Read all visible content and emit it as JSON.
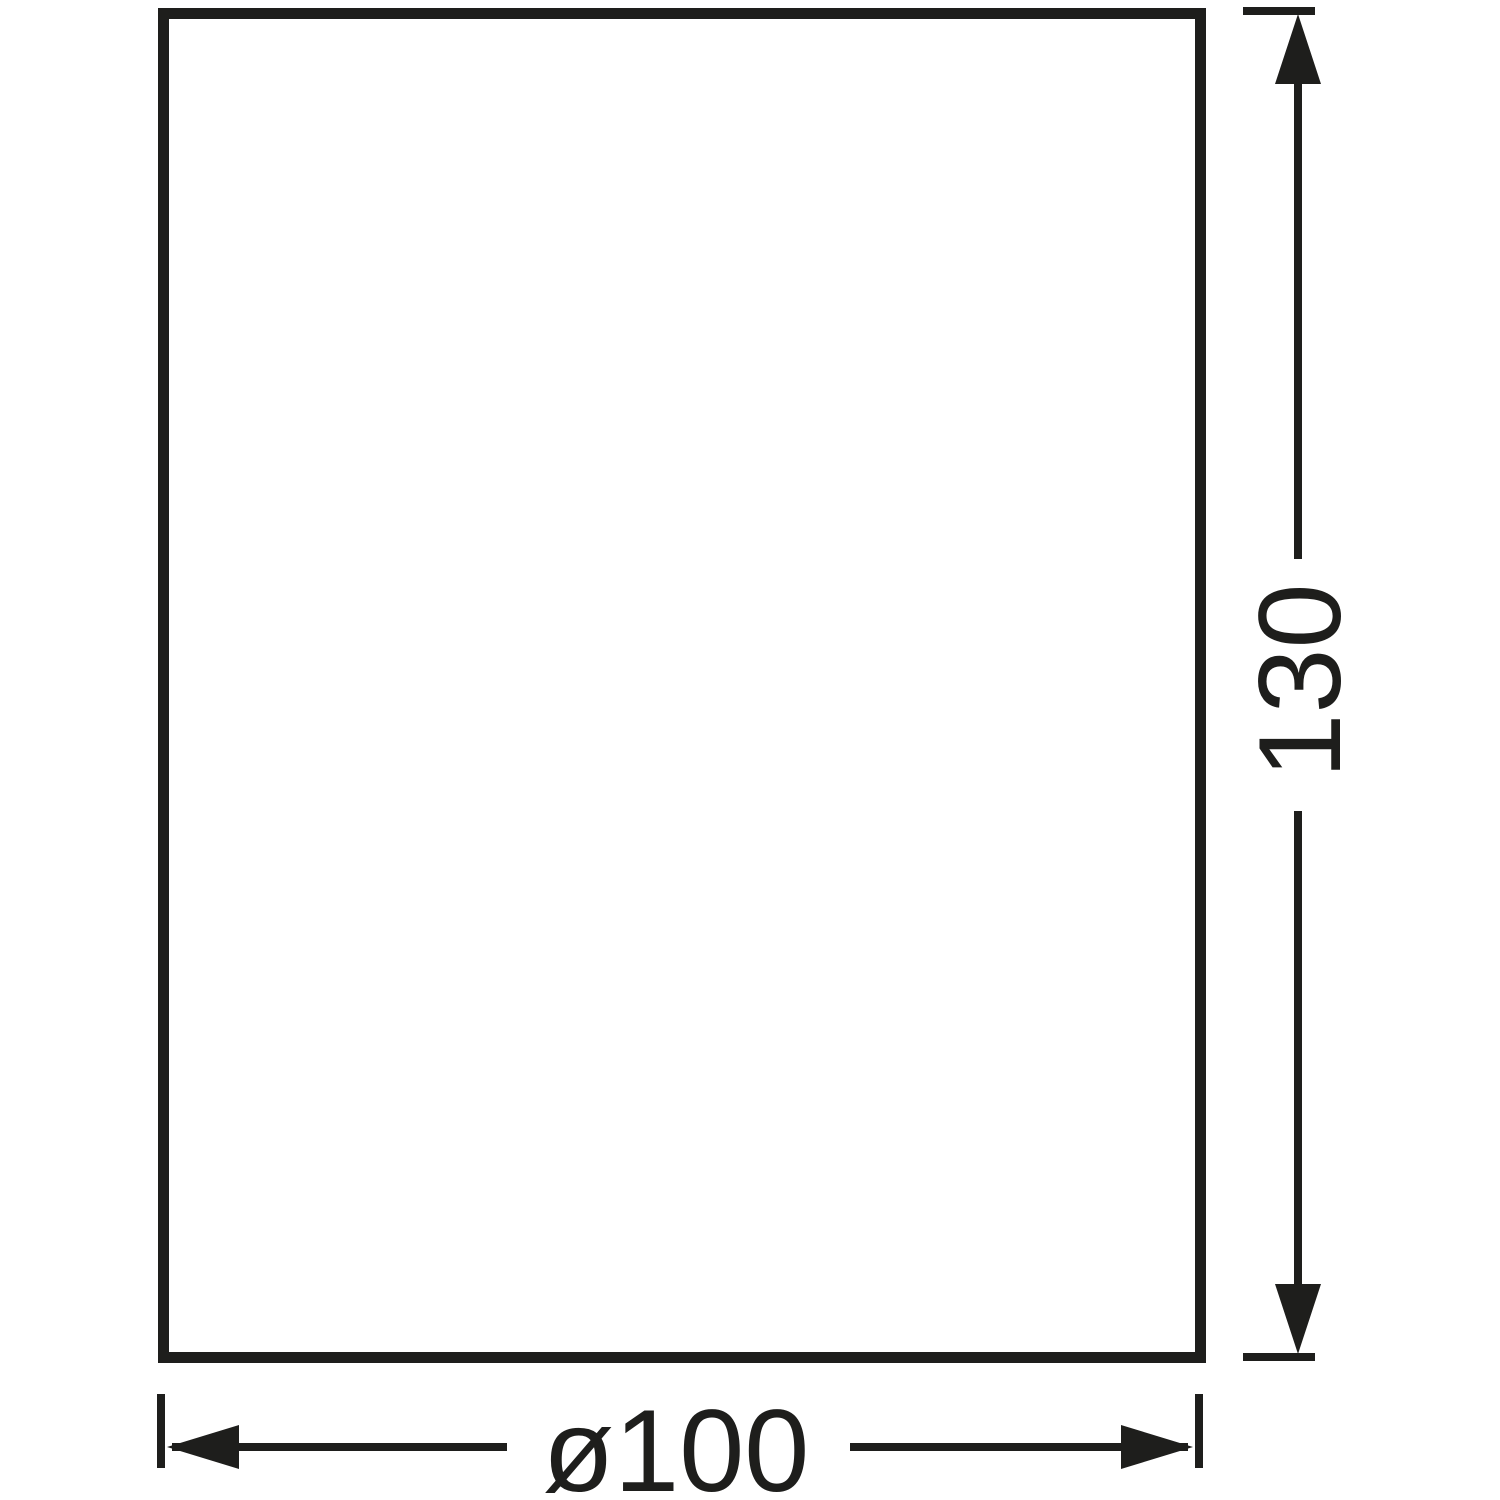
{
  "colors": {
    "ink": "#1e1e1c",
    "background": "#ffffff"
  },
  "drawing": {
    "height_dimension": {
      "label": "130"
    },
    "width_dimension": {
      "label": "ø100"
    }
  }
}
